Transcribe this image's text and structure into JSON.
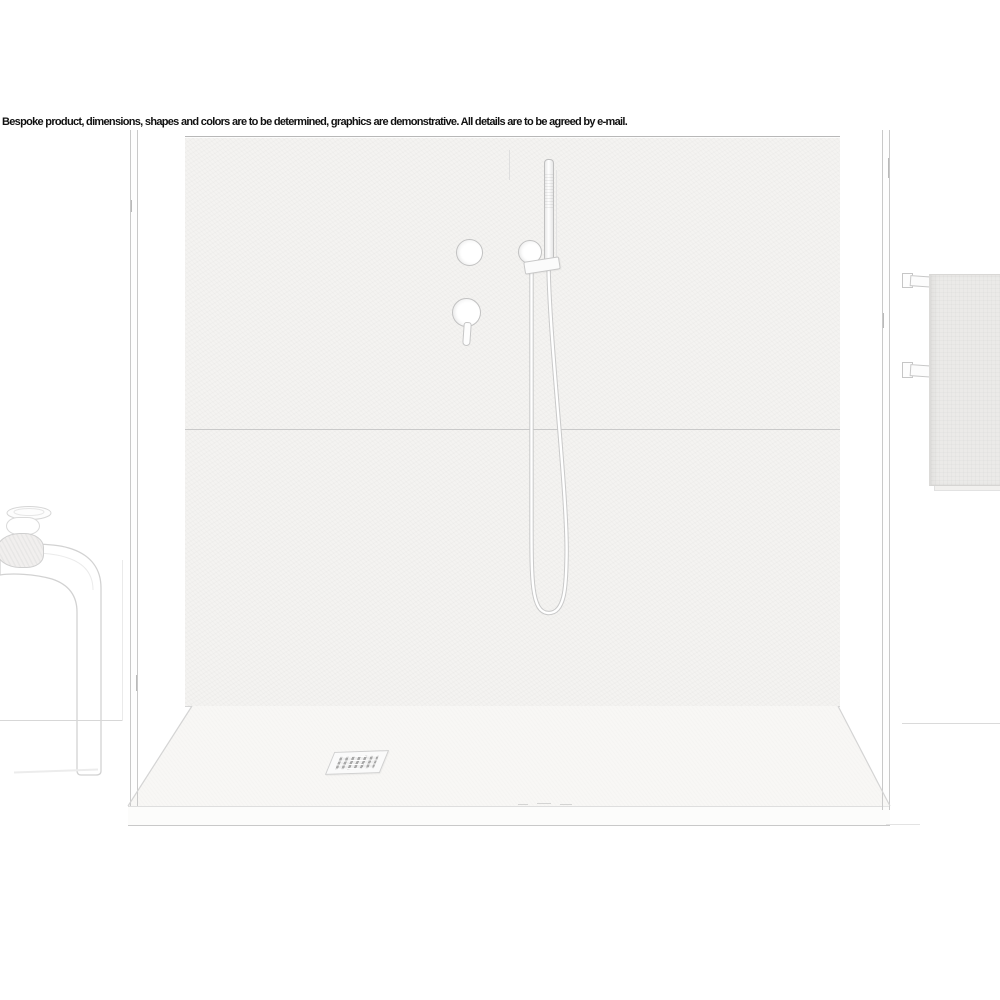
{
  "banner": {
    "text": "Bespoke product, dimensions, shapes and colors are to be determined, graphics are demonstrative. All details are to be agreed by e-mail."
  },
  "colors": {
    "background": "#ffffff",
    "text": "#111111",
    "wall_fill": "#f4f3f1",
    "tray_fill": "#f8f7f5",
    "towel_fill": "#ebeae8",
    "line_strong": "#b8b8b8",
    "line_mid": "#c9c9c9",
    "line_soft": "#d6d6d6",
    "grate_slot": "#a8a8a8"
  }
}
